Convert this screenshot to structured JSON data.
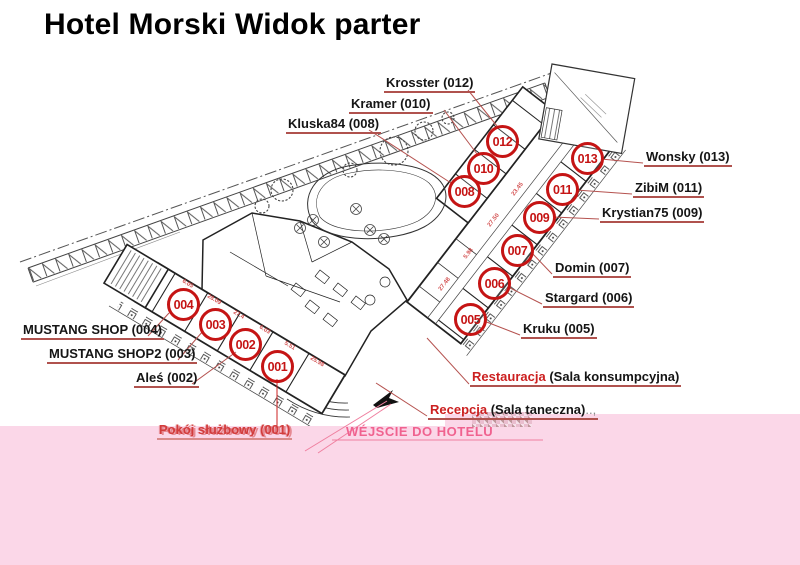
{
  "title": "Hotel Morski Widok parter",
  "rooms": [
    {
      "number": "001",
      "name": "Pokój służbowy (001)"
    },
    {
      "number": "002",
      "name": "Aleś (002)"
    },
    {
      "number": "003",
      "name": "MUSTANG SHOP2 (003)"
    },
    {
      "number": "004",
      "name": "MUSTANG SHOP (004)"
    },
    {
      "number": "005",
      "name": "Kruku (005)"
    },
    {
      "number": "006",
      "name": "Stargard (006)"
    },
    {
      "number": "007",
      "name": "Domin (007)"
    },
    {
      "number": "008",
      "name": "Kluska84 (008)"
    },
    {
      "number": "009",
      "name": "Krystian75 (009)"
    },
    {
      "number": "010",
      "name": "Kramer (010)"
    },
    {
      "number": "011",
      "name": "ZibiM (011)"
    },
    {
      "number": "012",
      "name": "Krosster (012)"
    },
    {
      "number": "013",
      "name": "Wonsky (013)"
    }
  ],
  "areas": {
    "restaurant": {
      "red": "Restauracja",
      "black": " (Sala konsumpcyjna)"
    },
    "reception": {
      "red": "Recepcja",
      "black": " (Sala taneczna)",
      "suffix": "..,"
    }
  },
  "entrance": {
    "label": "WÉJSCIE DO HOTELU"
  },
  "dims": [
    "6.05",
    "28.09",
    "27.4",
    "6.03",
    "5.51",
    "25.98",
    "27.48",
    "5.98",
    "27.50",
    "23.45"
  ],
  "colors": {
    "marker_red": "#c51414",
    "leader_red": "#b0524e",
    "red_text": "#cc2020",
    "pink_overlay": "#fbd7e8",
    "pink_text": "#f0628f",
    "title": "#000000"
  }
}
